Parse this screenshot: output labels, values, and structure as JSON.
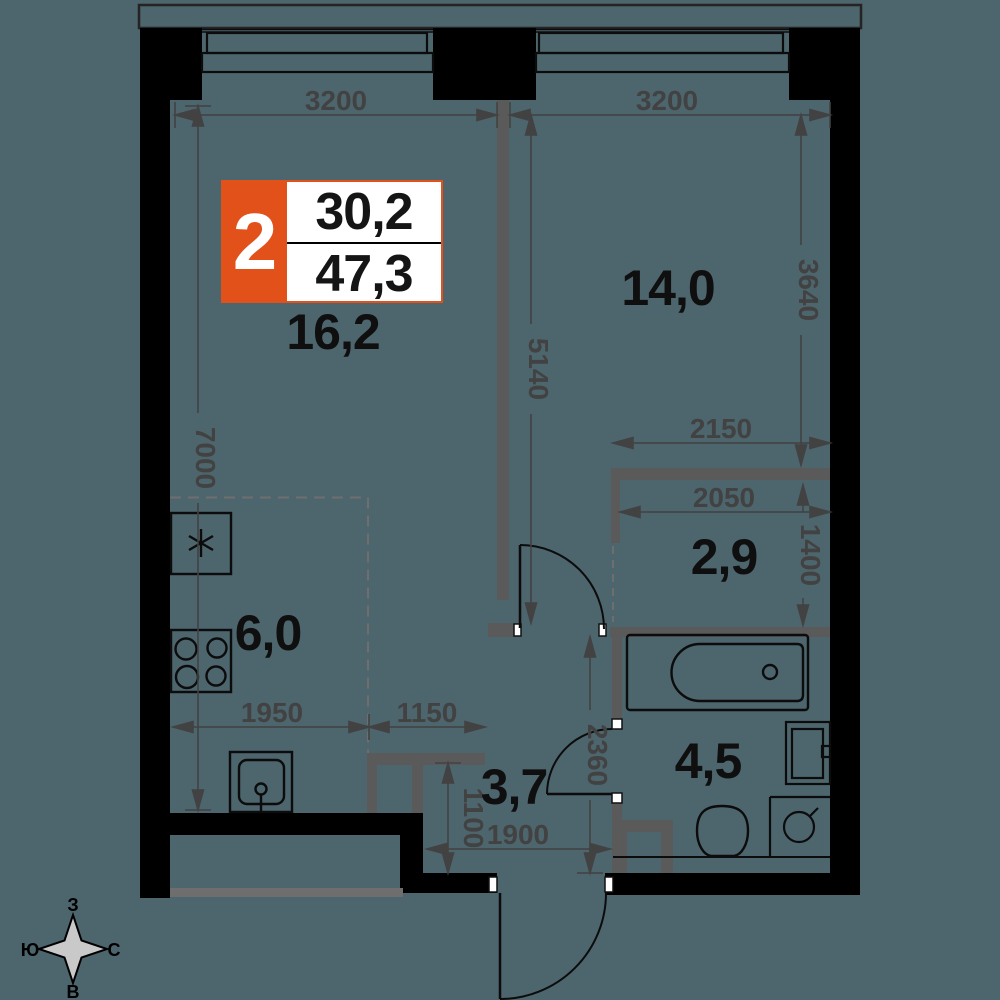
{
  "colors": {
    "background": "#4d656d",
    "walls": "#000000",
    "partitions": "#5a5a5a",
    "dimension_graphics": "#424242",
    "accent_orange": "#e2511a",
    "white": "#ffffff",
    "compass_star": "#c9c9c9",
    "balcony_rail": "#6e6e6e"
  },
  "badge": {
    "rooms_count": "2",
    "upper_value": "30,2",
    "lower_value": "47,3"
  },
  "areas": {
    "living": "16,2",
    "bedroom": "14,0",
    "kitchen": "6,0",
    "wardrobe": "2,9",
    "bathroom": "4,5",
    "hallway": "3,7"
  },
  "dims": {
    "win_left": "3200",
    "win_right": "3200",
    "left_wall": "7000",
    "partition": "5140",
    "bedroom_right": "3640",
    "wardrobe_top": "2150",
    "wardrobe_inner": "2050",
    "wardrobe_side": "1400",
    "bath_side": "2360",
    "kitchen_width": "1950",
    "portal": "1150",
    "hall_bottom": "1900",
    "hall_side": "1100"
  },
  "compass": {
    "top": "З",
    "left": "Ю",
    "right": "С",
    "bottom": "В"
  }
}
